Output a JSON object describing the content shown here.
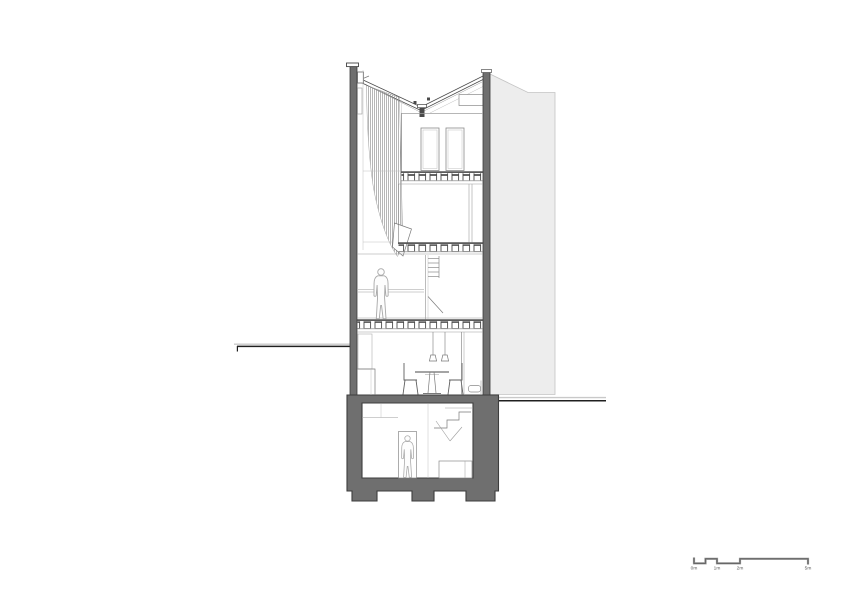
{
  "page": {
    "background": "#ffffff",
    "content_type": "building-section-drawing"
  },
  "colors": {
    "wall": "#6f6f6f",
    "wall_outline": "#3d3d3d",
    "adjacent_building": "#ededed",
    "adjacent_outline": "#c4c4c4",
    "hatch": "#8f8f8f",
    "ground_line": "#1f1f1f",
    "ground_line_light": "#c9c9c9",
    "scale_bar": "#8f8f8f",
    "scale_bar_edge": "#4f4f4f"
  },
  "scale_bar": {
    "labels": [
      "0m",
      "1m",
      "2m",
      "5m"
    ]
  },
  "figures": {
    "third_floor": "standing-person",
    "basement": "standing-person"
  }
}
